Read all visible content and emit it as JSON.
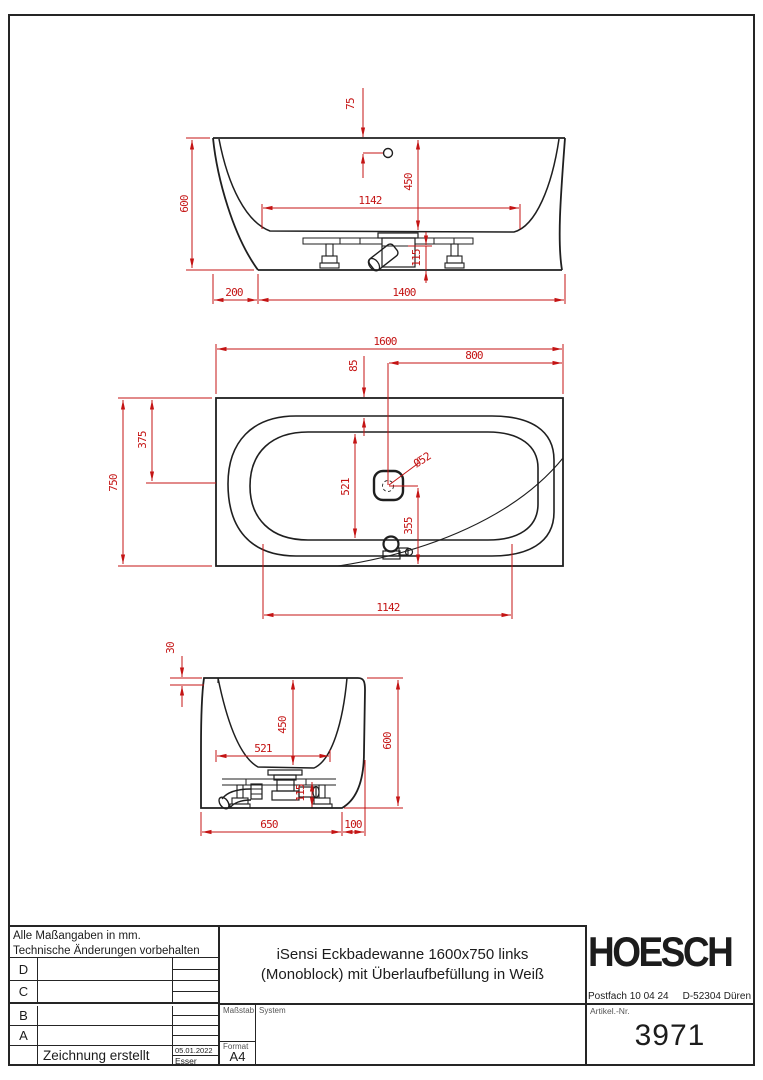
{
  "colors": {
    "dim_red": "#c41414",
    "line_black": "#1f1f1f"
  },
  "views": {
    "front": {
      "d75": "75",
      "d600": "600",
      "d450": "450",
      "d1142": "1142",
      "d115": "115",
      "d200": "200",
      "d1400": "1400"
    },
    "plan": {
      "d1600": "1600",
      "d800": "800",
      "d85": "85",
      "d750": "750",
      "d375": "375",
      "d521": "521",
      "ddia": "Ø52",
      "d355": "355",
      "d1142": "1142"
    },
    "side": {
      "d30": "30",
      "d450": "450",
      "d521": "521",
      "d600": "600",
      "d115": "115",
      "d650": "650",
      "d100": "100"
    }
  },
  "title_block": {
    "note_line1": "Alle Maßangaben in mm.",
    "note_line2": "Technische Änderungen vorbehalten",
    "revision_rows": [
      "D",
      "C",
      "B",
      "A"
    ],
    "created_label": "Zeichnung erstellt",
    "created_date": "05.01.2022",
    "created_by": "Esser",
    "scale_label": "Maßstab",
    "system_label": "System",
    "format_label": "Format",
    "format_value": "A4",
    "title_line1": "iSensi Eckbadewanne 1600x750 links",
    "title_line2": "(Monoblock) mit Überlaufbefüllung in Weiß",
    "brand": "HOESCH",
    "address_left": "Postfach 10 04 24",
    "address_right": "D-52304 Düren",
    "article_label": "Artikel.-Nr.",
    "article_number": "3971"
  }
}
